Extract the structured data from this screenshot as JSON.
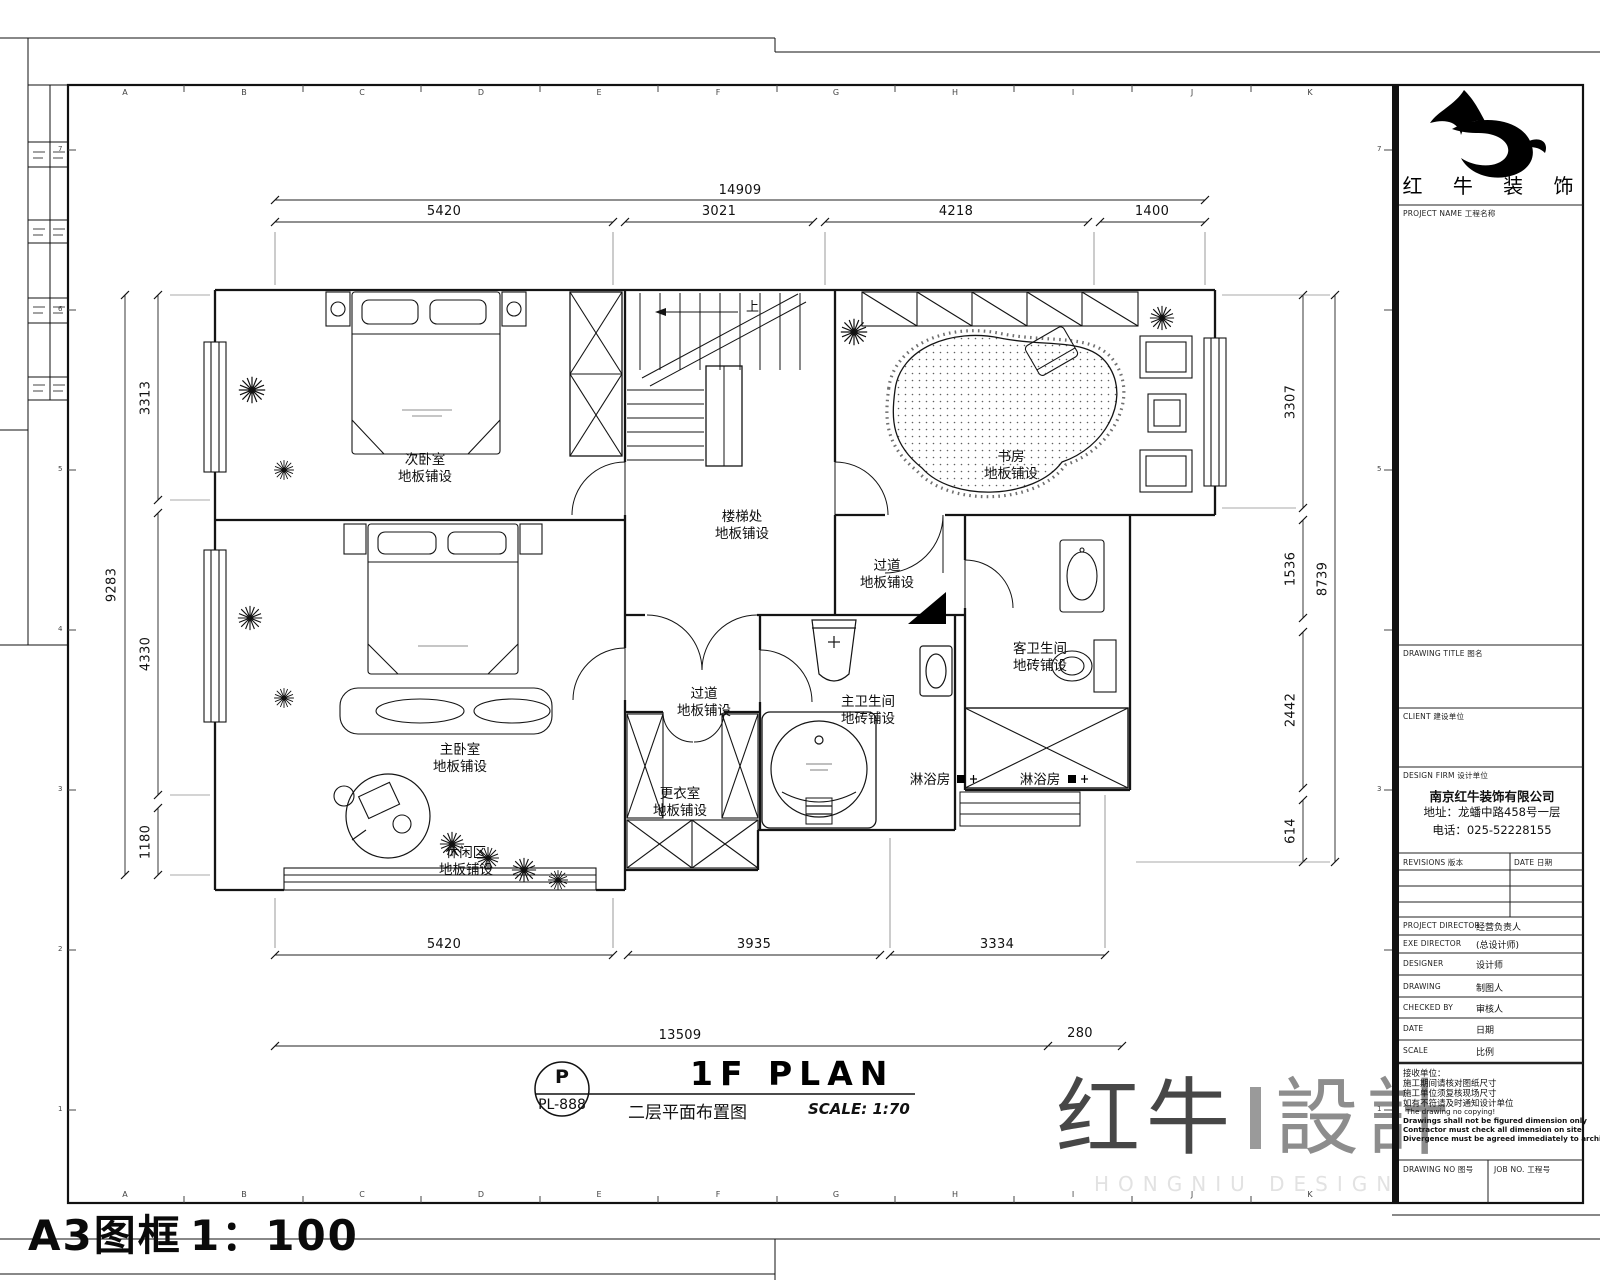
{
  "page": {
    "grid_letters": [
      "A",
      "B",
      "C",
      "D",
      "E",
      "F",
      "G",
      "H",
      "I",
      "J",
      "K"
    ],
    "grid_numbers": [
      "7",
      "6",
      "5",
      "4",
      "3",
      "2",
      "1"
    ],
    "frame_label": "A3图框",
    "frame_scale": "1：100"
  },
  "title_block": {
    "logo_name": "红 牛 装 饰",
    "project_name_label": "PROJECT NAME 工程名称",
    "drawing_title_label": "DRAWING TITLE 图名",
    "client_label": "CLIENT 建设单位",
    "design_firm_label": "DESIGN FIRM 设计单位",
    "company_name": "南京红牛装饰有限公司",
    "company_address": "地址：龙蟠中路458号一层",
    "company_phone": "电话：025-52228155",
    "revisions_label": "REVISIONS 版本",
    "revisions_date_label": "DATE 日期",
    "rows": [
      {
        "label": "PROJECT DIRECTOR",
        "value": "经营负责人"
      },
      {
        "label": "EXE DIRECTOR",
        "value": "(总设计师)"
      },
      {
        "label": "DESIGNER",
        "value": "设计师"
      },
      {
        "label": "DRAWING",
        "value": "制图人"
      },
      {
        "label": "CHECKED BY",
        "value": "审核人"
      },
      {
        "label": "DATE",
        "value": "日期"
      },
      {
        "label": "SCALE",
        "value": "比例"
      }
    ],
    "notes": [
      "接收单位：",
      "施工期间请核对图纸尺寸",
      "施工单位须复核现场尺寸",
      "如有不符请及时通知设计单位",
      "The drawing no copying!",
      "Drawings shall not be figured dimension only",
      "Contractor must check all dimension on site",
      "Divergence must be agreed immediately to architects"
    ],
    "drawing_no_label": "DRAWING NO 图号",
    "job_no_label": "JOB NO. 工程号"
  },
  "plan": {
    "stair_up": "上",
    "rooms": [
      {
        "name": "次卧室",
        "finish": "地板铺设"
      },
      {
        "name": "楼梯处",
        "finish": "地板铺设"
      },
      {
        "name": "过道",
        "finish": "地板铺设"
      },
      {
        "name": "书房",
        "finish": "地板铺设"
      },
      {
        "name": "客卫生间",
        "finish": "地砖铺设"
      },
      {
        "name": "主卫生间",
        "finish": "地砖铺设"
      },
      {
        "name": "过道",
        "finish": "地板铺设"
      },
      {
        "name": "主卧室",
        "finish": "地板铺设"
      },
      {
        "name": "更衣室",
        "finish": "地板铺设"
      },
      {
        "name": "休闲区",
        "finish": "地板铺设"
      },
      {
        "name": "淋浴房",
        "finish": ""
      },
      {
        "name": "淋浴房",
        "finish": ""
      }
    ],
    "dims": {
      "top_total": "14909",
      "top": [
        "5420",
        "3021",
        "4218",
        "1400"
      ],
      "left_total": "9283",
      "left": [
        "3313",
        "4330",
        "1180"
      ],
      "right_total": "8739",
      "right": [
        "3307",
        "1536",
        "2442",
        "614"
      ],
      "bottom": [
        "5420",
        "3935",
        "3334"
      ],
      "bottom_total": "13509",
      "bottom_offset": "280"
    },
    "titlebar": {
      "bubble_top": "P",
      "bubble_no": "PL-888",
      "title": "1F PLAN",
      "subtitle": "二层平面布置图",
      "scale_text": "SCALE: 1:70"
    }
  },
  "watermark": {
    "name": "红牛",
    "word": "設計",
    "tagline": "HONGNIU DESIGN"
  }
}
